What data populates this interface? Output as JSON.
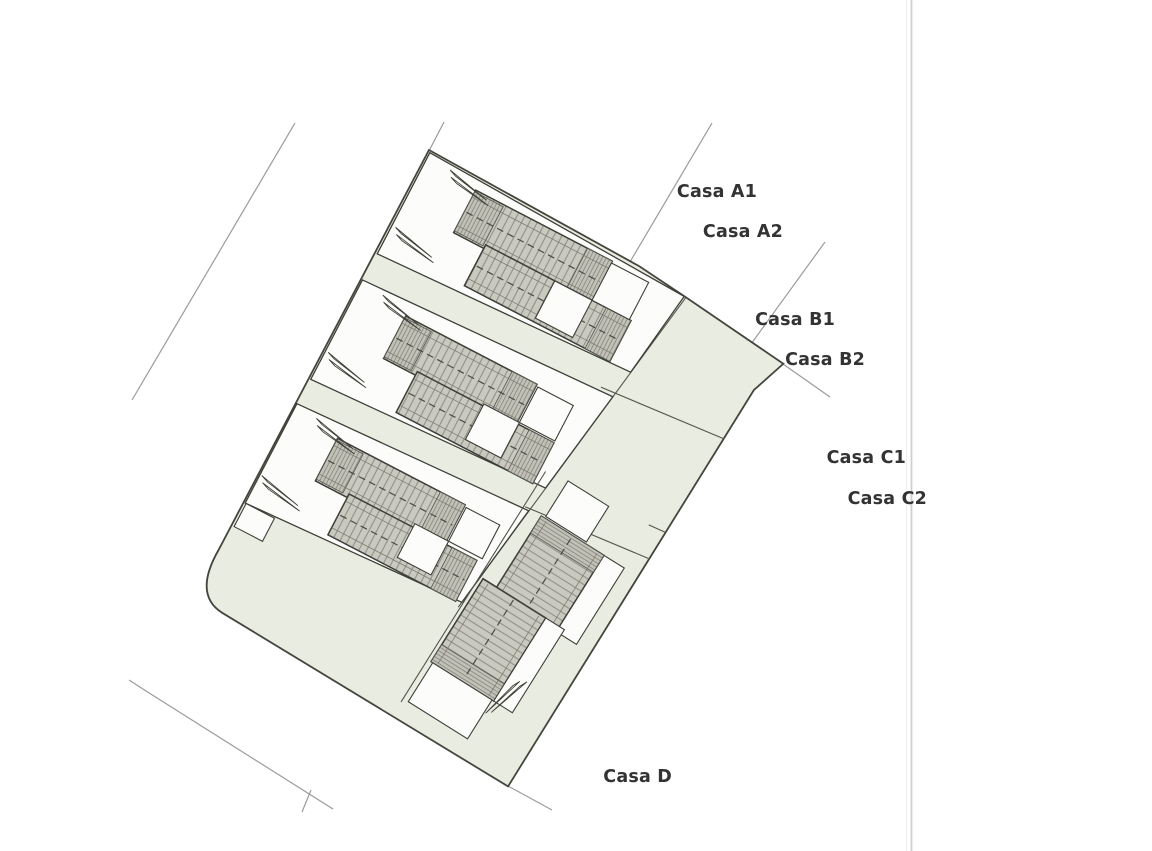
{
  "page": {
    "background": "#ffffff"
  },
  "divider": {
    "x": 912
  },
  "colors": {
    "site_fill": "#e9ede1",
    "plot_fill": "#fcfcfa",
    "roof_fill": "#cac9bf",
    "roof_hatch_line": "#90908a",
    "outline": "#3e3e38",
    "boundary": "#45453e",
    "survey_line": "#9b9b9b",
    "label_text": "#333333"
  },
  "site_plan": {
    "houses": [
      {
        "id": "casa-a1",
        "label": "Casa A1",
        "label_right": 757,
        "label_top": 183
      },
      {
        "id": "casa-a2",
        "label": "Casa A2",
        "label_right": 783,
        "label_top": 223
      },
      {
        "id": "casa-b1",
        "label": "Casa B1",
        "label_right": 835,
        "label_top": 311
      },
      {
        "id": "casa-b2",
        "label": "Casa B2",
        "label_right": 865,
        "label_top": 351
      },
      {
        "id": "casa-c1",
        "label": "Casa C1",
        "label_right": 906,
        "label_top": 449
      },
      {
        "id": "casa-c2",
        "label": "Casa C2",
        "label_right": 927,
        "label_top": 490
      },
      {
        "id": "casa-d",
        "label": "Casa D",
        "label_right": 672,
        "label_top": 768
      }
    ]
  }
}
